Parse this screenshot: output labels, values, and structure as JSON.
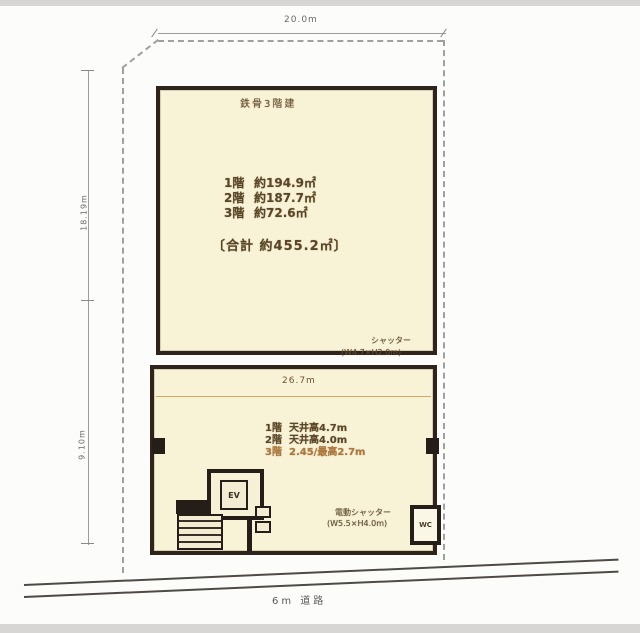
{
  "drawing": {
    "top_dimension": "20.0m",
    "left_dimension_upper": "18.19m",
    "left_dimension_lower": "9.10m",
    "road_label": "6m 道路",
    "upper_building": {
      "structure_label": "鉄骨3階建",
      "floor_areas": [
        {
          "floor": "1階",
          "area": "約194.9㎡"
        },
        {
          "floor": "2階",
          "area": "約187.7㎡"
        },
        {
          "floor": "3階",
          "area": "約72.6㎡"
        }
      ],
      "total_area": "〔合計 約455.2㎡〕"
    },
    "lower_building": {
      "width_dimension": "26.7m",
      "ceiling_notes": [
        {
          "floor": "1階",
          "note": "天井高4.7m"
        },
        {
          "floor": "2階",
          "note": "天井高4.0m"
        },
        {
          "floor": "3階",
          "note": "2.45/最高2.7m"
        }
      ],
      "elevator_label": "EV",
      "corner_room_label": "WC"
    },
    "annotations": {
      "shutter_line1": "シャッター",
      "shutter_line2": "(W4.7×H2.0m)",
      "electric_shutter_line1": "電動シャッター",
      "electric_shutter_line2": "(W5.5×H4.0m)"
    },
    "colors": {
      "building_fill": "#f8f3d7",
      "building_border": "#2e241c",
      "text_brown": "#5a4526",
      "text_orange": "#b0763a",
      "dimension_gray": "#9b9b99"
    }
  }
}
